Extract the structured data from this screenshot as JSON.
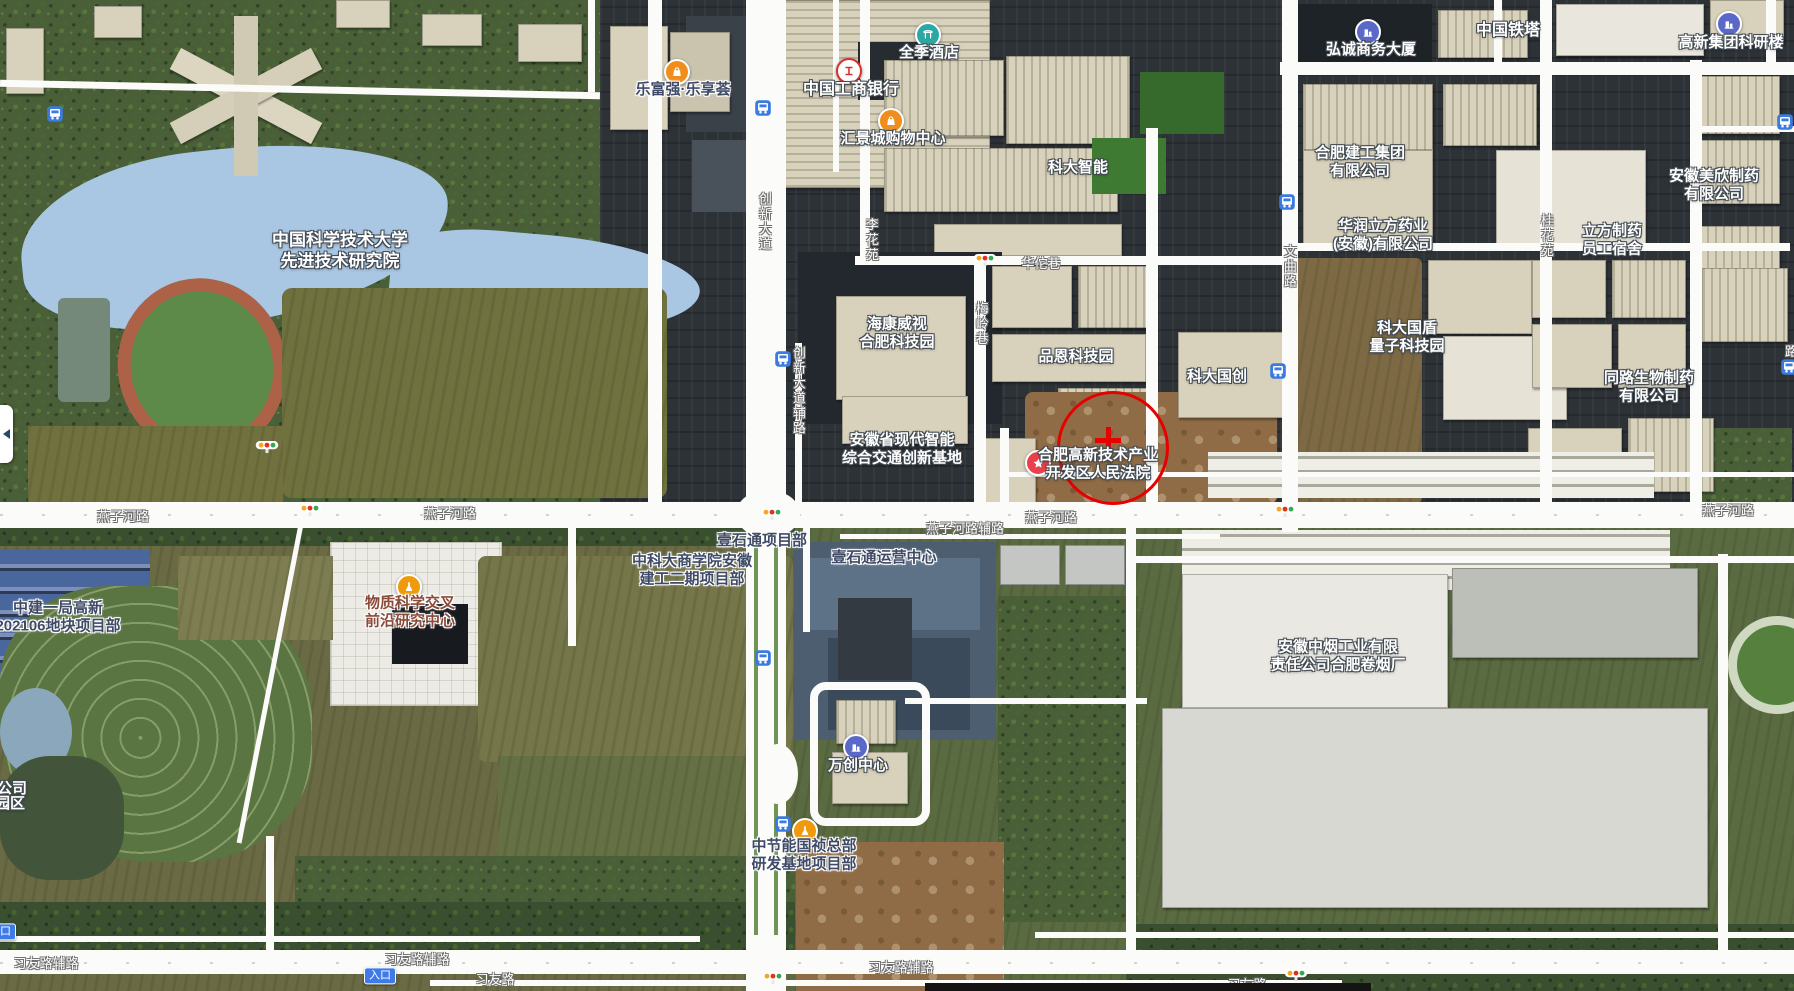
{
  "map": {
    "width": 1794,
    "height": 991,
    "colors": {
      "annotation_red": "#e60000",
      "bus_blue": "#3b7bde",
      "poi_orange": "#f08e1d",
      "poi_indigo": "#5a69c9",
      "poi_teal": "#2ba8a3",
      "poi_red": "#e8414b",
      "badge_blue": "#3e7be8"
    },
    "labels": [
      {
        "name": "poi-ustc-advanced-institute",
        "lines": [
          "中国科学技术大学",
          "先进技术研究院"
        ],
        "x": 340,
        "y": 251,
        "style": "w",
        "size": 17,
        "clickable": true
      },
      {
        "name": "poi-lefuqiang-lexianghui",
        "lines": [
          "乐富强·乐享荟"
        ],
        "x": 683,
        "y": 90,
        "style": "d",
        "clickable": true
      },
      {
        "name": "poi-icbc-bank",
        "lines": [
          "中国工商银行"
        ],
        "x": 851,
        "y": 90,
        "style": "w",
        "size": 16,
        "clickable": true
      },
      {
        "name": "poi-ji-hotel",
        "lines": [
          "全季酒店"
        ],
        "x": 929,
        "y": 53,
        "style": "w",
        "clickable": true
      },
      {
        "name": "poi-huijingcheng-mall",
        "lines": [
          "汇景城购物中心"
        ],
        "x": 893,
        "y": 139,
        "style": "w",
        "clickable": true
      },
      {
        "name": "poi-keda-intelligent",
        "lines": [
          "科大智能"
        ],
        "x": 1078,
        "y": 168,
        "style": "w",
        "clickable": true
      },
      {
        "name": "poi-hikvision-hefei-park",
        "lines": [
          "海康威视",
          "合肥科技园"
        ],
        "x": 897,
        "y": 334,
        "style": "w",
        "clickable": true
      },
      {
        "name": "poi-pinen-tech-park",
        "lines": [
          "品恩科技园"
        ],
        "x": 1076,
        "y": 357,
        "style": "w",
        "clickable": true
      },
      {
        "name": "poi-keda-guochuang",
        "lines": [
          "科大国创"
        ],
        "x": 1217,
        "y": 377,
        "style": "w",
        "clickable": true
      },
      {
        "name": "poi-hongcheng-business-tower",
        "lines": [
          "弘诚商务大厦"
        ],
        "x": 1371,
        "y": 50,
        "style": "w",
        "clickable": true
      },
      {
        "name": "poi-china-tower",
        "lines": [
          "中国铁塔"
        ],
        "x": 1508,
        "y": 31,
        "style": "w",
        "size": 16,
        "clickable": true
      },
      {
        "name": "poi-gaoxin-group-research-bldg",
        "lines": [
          "高新集团科研楼"
        ],
        "x": 1731,
        "y": 43,
        "style": "w",
        "clickable": true
      },
      {
        "name": "poi-hefei-construction-group",
        "lines": [
          "合肥建工集团",
          "有限公司"
        ],
        "x": 1360,
        "y": 163,
        "style": "w",
        "clickable": true
      },
      {
        "name": "poi-huarun-lifang-pharma",
        "lines": [
          "华润立方药业",
          "(安徽)有限公司"
        ],
        "x": 1383,
        "y": 236,
        "style": "w",
        "clickable": true
      },
      {
        "name": "poi-anhui-meixin-pharma",
        "lines": [
          "安徽美欣制药",
          "有限公司"
        ],
        "x": 1714,
        "y": 186,
        "style": "w",
        "clickable": true
      },
      {
        "name": "poi-lifang-pharma-dorm",
        "lines": [
          "立方制药",
          "员工宿舍"
        ],
        "x": 1612,
        "y": 241,
        "style": "w",
        "clickable": true
      },
      {
        "name": "poi-quantum-tech-park",
        "lines": [
          "科大国盾",
          "量子科技园"
        ],
        "x": 1407,
        "y": 338,
        "style": "w",
        "clickable": true
      },
      {
        "name": "poi-tonglu-bio-pharma",
        "lines": [
          "同路生物制药",
          "有限公司"
        ],
        "x": 1649,
        "y": 388,
        "style": "w",
        "clickable": true
      },
      {
        "name": "poi-smart-transport-innovation-base",
        "lines": [
          "安徽省现代智能",
          "综合交通创新基地"
        ],
        "x": 902,
        "y": 450,
        "style": "w",
        "clickable": true
      },
      {
        "name": "poi-hightech-zone-court",
        "lines": [
          "合肥高新技术产业",
          "开发区人民法院"
        ],
        "x": 1098,
        "y": 465,
        "style": "w",
        "clickable": true
      },
      {
        "name": "poi-physical-science-frontier-center",
        "lines": [
          "物质科学交叉",
          "前沿研究中心"
        ],
        "x": 410,
        "y": 613,
        "style": "b",
        "clickable": true
      },
      {
        "name": "poi-zhongjian-yiju-project",
        "lines": [
          "中建一局高新",
          "202106地块项目部"
        ],
        "x": 58,
        "y": 618,
        "style": "d",
        "clickable": true
      },
      {
        "name": "poi-ustc-bizschool-project",
        "lines": [
          "中科大商学院安徽",
          "建工二期项目部"
        ],
        "x": 692,
        "y": 571,
        "style": "d",
        "clickable": true
      },
      {
        "name": "poi-yishitong-project",
        "lines": [
          "壹石通项目部"
        ],
        "x": 762,
        "y": 541,
        "style": "d",
        "clickable": true
      },
      {
        "name": "poi-yishitong-ops-center",
        "lines": [
          "壹石通运营中心"
        ],
        "x": 884,
        "y": 558,
        "style": "d",
        "clickable": true
      },
      {
        "name": "poi-wanchuang-center",
        "lines": [
          "万创中心"
        ],
        "x": 858,
        "y": 766,
        "style": "w",
        "clickable": true
      },
      {
        "name": "poi-cecep-guozhen-project",
        "lines": [
          "中节能国祯总部",
          "研发基地项目部"
        ],
        "x": 804,
        "y": 856,
        "style": "d",
        "clickable": true
      },
      {
        "name": "poi-anhui-tobacco-factory",
        "lines": [
          "安徽中烟工业有限",
          "责任公司合肥卷烟厂"
        ],
        "x": 1338,
        "y": 657,
        "style": "w",
        "clickable": true
      },
      {
        "name": "poi-clipped-company",
        "lines": [
          "公司"
        ],
        "x": 12,
        "y": 789,
        "style": "w",
        "clickable": true
      },
      {
        "name": "poi-clipped-park",
        "lines": [
          "园区"
        ],
        "x": 10,
        "y": 804,
        "style": "w",
        "clickable": true
      },
      {
        "name": "road-yanzihe-1",
        "lines": [
          "燕子河路"
        ],
        "x": 123,
        "y": 517,
        "style": "road",
        "clickable": false
      },
      {
        "name": "road-yanzihe-2",
        "lines": [
          "燕子河路"
        ],
        "x": 450,
        "y": 514,
        "style": "road",
        "clickable": false
      },
      {
        "name": "road-yanzihe-3",
        "lines": [
          "燕子河路"
        ],
        "x": 1051,
        "y": 518,
        "style": "road",
        "clickable": false
      },
      {
        "name": "road-yanzihe-4",
        "lines": [
          "燕子河路"
        ],
        "x": 1728,
        "y": 511,
        "style": "road",
        "clickable": false
      },
      {
        "name": "road-yanzihe-fulu",
        "lines": [
          "燕子河路辅路"
        ],
        "x": 965,
        "y": 529,
        "style": "road",
        "clickable": false
      },
      {
        "name": "road-xiyou-fulu-1",
        "lines": [
          "习友路辅路"
        ],
        "x": 46,
        "y": 964,
        "style": "road",
        "clickable": false
      },
      {
        "name": "road-xiyou-fulu-2",
        "lines": [
          "习友路辅路"
        ],
        "x": 417,
        "y": 960,
        "style": "road",
        "clickable": false
      },
      {
        "name": "road-xiyou-fulu-3",
        "lines": [
          "习友路辅路"
        ],
        "x": 901,
        "y": 968,
        "style": "road",
        "clickable": false
      },
      {
        "name": "road-xiyou-1",
        "lines": [
          "习友路"
        ],
        "x": 495,
        "y": 980,
        "style": "road",
        "clickable": false
      },
      {
        "name": "road-xiyou-2",
        "lines": [
          "习友路"
        ],
        "x": 1247,
        "y": 985,
        "style": "road",
        "clickable": false
      },
      {
        "name": "road-huatuo-lane",
        "lines": [
          "华佗巷"
        ],
        "x": 1041,
        "y": 264,
        "style": "road",
        "clickable": false
      },
      {
        "name": "road-meiling-lane",
        "lines": [
          "梅岭巷"
        ],
        "x": 981,
        "y": 324,
        "style": "road",
        "vertical": true,
        "clickable": false
      },
      {
        "name": "road-chuangxin-ave",
        "lines": [
          "创新大道"
        ],
        "x": 764,
        "y": 222,
        "style": "road",
        "vertical": true,
        "clickable": false
      },
      {
        "name": "road-chuangxin-ave-fulu",
        "lines": [
          "创新大道辅路"
        ],
        "x": 798,
        "y": 391,
        "style": "road",
        "vertical": true,
        "clickable": false
      },
      {
        "name": "road-wenqu",
        "lines": [
          "文曲路"
        ],
        "x": 1289,
        "y": 267,
        "style": "road",
        "vertical": true,
        "clickable": false
      },
      {
        "name": "road-lihua-yuan",
        "lines": [
          "李花苑"
        ],
        "x": 871,
        "y": 240,
        "style": "road",
        "vertical": true,
        "clickable": false
      },
      {
        "name": "road-guihua-yuan",
        "lines": [
          "桂花苑"
        ],
        "x": 1546,
        "y": 236,
        "style": "road",
        "vertical": true,
        "clickable": false
      },
      {
        "name": "road-clipped-right",
        "lines": [
          "路"
        ],
        "x": 1790,
        "y": 352,
        "style": "road",
        "vertical": true,
        "clickable": false
      }
    ],
    "icons": [
      {
        "name": "bus-stop-icon",
        "type": "bus",
        "x": 55,
        "y": 114,
        "clickable": true
      },
      {
        "name": "bus-stop-icon",
        "type": "bus",
        "x": 763,
        "y": 108,
        "clickable": true
      },
      {
        "name": "bus-stop-icon",
        "type": "bus",
        "x": 1287,
        "y": 202,
        "clickable": true
      },
      {
        "name": "bus-stop-icon",
        "type": "bus",
        "x": 1785,
        "y": 122,
        "clickable": true
      },
      {
        "name": "bus-stop-icon",
        "type": "bus",
        "x": 1278,
        "y": 371,
        "clickable": true
      },
      {
        "name": "bus-stop-icon",
        "type": "bus",
        "x": 783,
        "y": 359,
        "clickable": true
      },
      {
        "name": "bus-stop-icon",
        "type": "bus",
        "x": 763,
        "y": 658,
        "clickable": true
      },
      {
        "name": "bus-stop-icon",
        "type": "bus",
        "x": 783,
        "y": 824,
        "clickable": true
      },
      {
        "name": "bus-stop-icon",
        "type": "bus",
        "x": 1789,
        "y": 367,
        "clickable": true
      },
      {
        "name": "traffic-light-icon",
        "type": "traffic",
        "x": 985,
        "y": 262,
        "clickable": false
      },
      {
        "name": "traffic-light-icon",
        "type": "traffic",
        "x": 267,
        "y": 449,
        "clickable": false
      },
      {
        "name": "traffic-light-icon",
        "type": "traffic",
        "x": 310,
        "y": 512,
        "clickable": false
      },
      {
        "name": "traffic-light-icon",
        "type": "traffic",
        "x": 772,
        "y": 516,
        "clickable": false
      },
      {
        "name": "traffic-light-icon",
        "type": "traffic",
        "x": 1285,
        "y": 513,
        "clickable": false
      },
      {
        "name": "traffic-light-icon",
        "type": "traffic",
        "x": 773,
        "y": 980,
        "clickable": false
      },
      {
        "name": "traffic-light-icon",
        "type": "traffic",
        "x": 1296,
        "y": 977,
        "clickable": false
      },
      {
        "name": "shopping-icon",
        "type": "shopping",
        "x": 677,
        "y": 72,
        "clickable": true
      },
      {
        "name": "bank-icon",
        "type": "bank",
        "x": 849,
        "y": 71,
        "clickable": true
      },
      {
        "name": "hotel-icon",
        "type": "hotel",
        "x": 928,
        "y": 35,
        "clickable": true
      },
      {
        "name": "shopping-icon",
        "type": "shopping",
        "x": 891,
        "y": 121,
        "clickable": true
      },
      {
        "name": "office-building-icon",
        "type": "building",
        "x": 1368,
        "y": 32,
        "clickable": true
      },
      {
        "name": "office-building-icon",
        "type": "building",
        "x": 1729,
        "y": 24,
        "clickable": true
      },
      {
        "name": "court-star-icon",
        "type": "court",
        "x": 1038,
        "y": 463,
        "clickable": true
      },
      {
        "name": "research-flask-icon",
        "type": "research",
        "x": 409,
        "y": 587,
        "clickable": true
      },
      {
        "name": "office-building-icon",
        "type": "building",
        "x": 856,
        "y": 747,
        "clickable": true
      },
      {
        "name": "research-flask-icon",
        "type": "research",
        "x": 805,
        "y": 831,
        "clickable": true
      },
      {
        "name": "entrance-badge",
        "type": "badge",
        "text": "入口",
        "x": 380,
        "y": 976,
        "clickable": false
      },
      {
        "name": "entrance-badge",
        "type": "badge",
        "text": "入口",
        "x": 0,
        "y": 932,
        "clickable": false
      }
    ],
    "annotation": {
      "color": "#e60000",
      "circle": {
        "cx": 1110,
        "cy": 445,
        "rx": 53,
        "ry": 54,
        "stroke": 3
      },
      "cross": {
        "x": 1108,
        "y": 440,
        "arm": 26,
        "thickness": 5
      }
    }
  },
  "statusbar": {
    "longitude_label": "经度",
    "longitude_value": "117.1278078878587",
    "latitude_label": "纬度",
    "latitude_value": "31.82500845474501",
    "search_label": "查询"
  }
}
